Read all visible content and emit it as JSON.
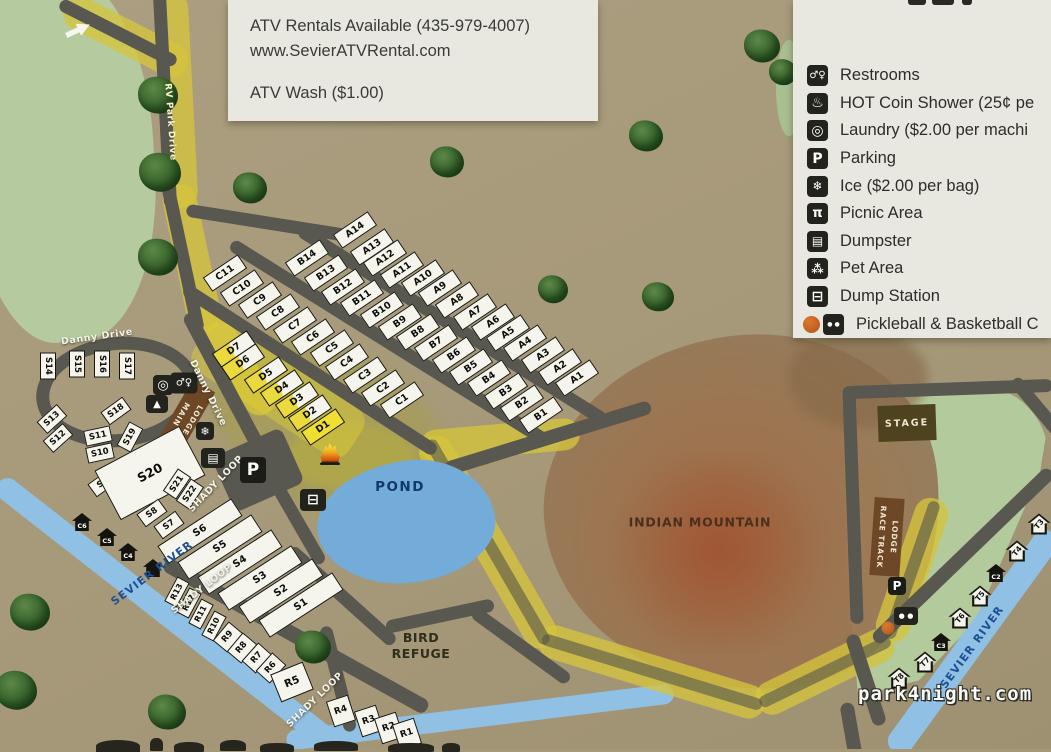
{
  "info_panel": {
    "line1": "ATV Rentals Available (435-979-4007)",
    "line2": "www.SevierATVRental.com",
    "line3": "ATV Wash ($1.00)"
  },
  "legend": {
    "items": [
      {
        "name": "restrooms",
        "glyph": "♂♀",
        "gsize": 10,
        "label": "Restrooms"
      },
      {
        "name": "hot-coin-shower",
        "glyph": "♨",
        "gsize": 14,
        "label": "HOT Coin Shower (25¢ pe"
      },
      {
        "name": "laundry",
        "glyph": "◎",
        "gsize": 14,
        "label": "Laundry ($2.00 per machi"
      },
      {
        "name": "parking",
        "glyph": "P",
        "gsize": 14,
        "label": "Parking"
      },
      {
        "name": "ice",
        "glyph": "❄",
        "gsize": 12,
        "label": "Ice ($2.00 per bag)"
      },
      {
        "name": "picnic-area",
        "glyph": "π",
        "gsize": 13,
        "label": "Picnic Area"
      },
      {
        "name": "dumpster",
        "glyph": "▤",
        "gsize": 12,
        "label": "Dumpster"
      },
      {
        "name": "pet-area",
        "glyph": "⁂",
        "gsize": 12,
        "label": "Pet Area"
      },
      {
        "name": "dump-station",
        "glyph": "⊟",
        "gsize": 14,
        "label": "Dump Station"
      },
      {
        "name": "pickleball-basketball",
        "glyph": "● ●",
        "gsize": 6,
        "label": "Pickleball & Basketball C",
        "ball": true
      }
    ]
  },
  "watermark": "park4night.com",
  "map": {
    "labels": [
      [
        "Danny Drive",
        97,
        337,
        -8,
        "road"
      ],
      [
        "Danny Drive",
        208,
        393,
        64,
        "road"
      ],
      [
        "RV Park Drive",
        170,
        122,
        86,
        "roadlt"
      ],
      [
        "SHADY LOOP",
        216,
        484,
        -46,
        "road"
      ],
      [
        "SHADY LOOP",
        202,
        589,
        -38,
        "road"
      ],
      [
        "SHADY LOOP",
        315,
        700,
        -44,
        "road"
      ],
      [
        "SEVIER RIVER",
        152,
        573,
        -37,
        "river"
      ],
      [
        "SEVIER RIVER",
        972,
        647,
        -54,
        "river"
      ],
      [
        "POND",
        400,
        487,
        0,
        "pond"
      ],
      [
        "BIRD\nREFUGE",
        421,
        646,
        0,
        "area"
      ],
      [
        "INDIAN MOUNTAIN",
        700,
        522,
        0,
        "mtn"
      ]
    ],
    "buildings": [
      {
        "label": "STAGE",
        "x": 907,
        "y": 423,
        "w": 58,
        "h": 36,
        "r": -2,
        "cls": "bld-stage",
        "name": "stage-building"
      },
      {
        "label": "RACE TRACK\nLODGE",
        "x": 887,
        "y": 537,
        "w": 30,
        "h": 78,
        "r": 4,
        "cls": "bld-vert",
        "name": "race-track-lodge-building"
      },
      {
        "label": "MAIN\nLODGE",
        "x": 186,
        "y": 417,
        "w": 26,
        "h": 72,
        "r": 30,
        "cls": "bld-vert",
        "name": "main-lodge-building"
      }
    ],
    "sites": [
      [
        "A14",
        355,
        230,
        -34,
        "ab"
      ],
      [
        "A13",
        372,
        247,
        -34,
        "ab"
      ],
      [
        "A12",
        385,
        258,
        -34,
        "ab"
      ],
      [
        "A11",
        402,
        270,
        -34,
        "ab"
      ],
      [
        "A10",
        423,
        278,
        -34,
        "ab"
      ],
      [
        "A9",
        440,
        288,
        -34,
        "ab"
      ],
      [
        "A8",
        457,
        300,
        -34,
        "ab"
      ],
      [
        "A7",
        475,
        312,
        -34,
        "ab"
      ],
      [
        "A6",
        493,
        322,
        -34,
        "ab"
      ],
      [
        "A5",
        508,
        333,
        -34,
        "ab"
      ],
      [
        "A4",
        525,
        343,
        -34,
        "ab"
      ],
      [
        "A3",
        543,
        355,
        -34,
        "ab"
      ],
      [
        "A2",
        560,
        367,
        -34,
        "ab"
      ],
      [
        "A1",
        577,
        378,
        -34,
        "ab"
      ],
      [
        "B14",
        307,
        258,
        -34,
        "ab"
      ],
      [
        "B13",
        326,
        273,
        -34,
        "ab"
      ],
      [
        "B12",
        343,
        287,
        -34,
        "ab"
      ],
      [
        "B11",
        362,
        298,
        -34,
        "ab"
      ],
      [
        "B10",
        382,
        310,
        -34,
        "ab"
      ],
      [
        "B9",
        400,
        322,
        -34,
        "ab"
      ],
      [
        "B8",
        418,
        332,
        -34,
        "ab"
      ],
      [
        "B7",
        436,
        343,
        -34,
        "ab"
      ],
      [
        "B6",
        454,
        355,
        -34,
        "ab"
      ],
      [
        "B5",
        471,
        367,
        -34,
        "ab"
      ],
      [
        "B4",
        489,
        378,
        -34,
        "ab"
      ],
      [
        "B3",
        506,
        391,
        -34,
        "ab"
      ],
      [
        "B2",
        522,
        403,
        -34,
        "ab"
      ],
      [
        "B1",
        541,
        415,
        -34,
        "ab"
      ],
      [
        "C11",
        225,
        273,
        -34,
        "ab"
      ],
      [
        "C10",
        242,
        288,
        -34,
        "ab"
      ],
      [
        "C9",
        260,
        300,
        -34,
        "ab"
      ],
      [
        "C8",
        278,
        312,
        -34,
        "ab"
      ],
      [
        "C7",
        295,
        325,
        -34,
        "ab"
      ],
      [
        "C6",
        313,
        337,
        -34,
        "ab"
      ],
      [
        "C5",
        332,
        348,
        -34,
        "ab"
      ],
      [
        "C4",
        347,
        362,
        -34,
        "ab"
      ],
      [
        "C3",
        365,
        375,
        -34,
        "ab"
      ],
      [
        "C2",
        383,
        388,
        -34,
        "ab"
      ],
      [
        "C1",
        402,
        400,
        -34,
        "ab"
      ],
      [
        "D7",
        234,
        349,
        -34,
        "d"
      ],
      [
        "D6",
        243,
        362,
        -34,
        "d"
      ],
      [
        "D5",
        266,
        375,
        -34,
        "d"
      ],
      [
        "D4",
        282,
        388,
        -34,
        "d"
      ],
      [
        "D3",
        297,
        400,
        -34,
        "d"
      ],
      [
        "D2",
        310,
        413,
        -34,
        "d"
      ],
      [
        "D1",
        323,
        427,
        -34,
        "d1"
      ],
      [
        "S14",
        48,
        366,
        90,
        "sv"
      ],
      [
        "S15",
        77,
        364,
        90,
        "sv"
      ],
      [
        "S16",
        102,
        364,
        90,
        "sv"
      ],
      [
        "S17",
        127,
        366,
        90,
        "sv"
      ],
      [
        "S13",
        52,
        419,
        -42,
        "sv"
      ],
      [
        "S12",
        58,
        438,
        -42,
        "sv"
      ],
      [
        "S18",
        116,
        411,
        -36,
        "sv"
      ],
      [
        "S11",
        98,
        436,
        -12,
        "sv"
      ],
      [
        "S10",
        100,
        453,
        -12,
        "sv"
      ],
      [
        "S19",
        130,
        437,
        -62,
        "sv"
      ],
      [
        "S9",
        103,
        483,
        -36,
        "sv"
      ],
      [
        "S20",
        150,
        473,
        -28,
        "s20"
      ],
      [
        "S21",
        177,
        484,
        -56,
        "sv"
      ],
      [
        "S22",
        190,
        494,
        -56,
        "sv"
      ],
      [
        "S8",
        152,
        513,
        -36,
        "sv"
      ],
      [
        "S7",
        169,
        525,
        -36,
        "sv"
      ],
      [
        "S6",
        200,
        531,
        -33,
        "lg"
      ],
      [
        "S5",
        220,
        547,
        -33,
        "lg"
      ],
      [
        "S4",
        240,
        562,
        -33,
        "lg"
      ],
      [
        "S3",
        260,
        578,
        -33,
        "lg"
      ],
      [
        "S2",
        281,
        591,
        -33,
        "lg"
      ],
      [
        "S1",
        301,
        605,
        -33,
        "lg"
      ],
      [
        "R13",
        177,
        592,
        -62,
        "rv"
      ],
      [
        "R12",
        189,
        603,
        -62,
        "rv"
      ],
      [
        "R11",
        201,
        614,
        -62,
        "rv"
      ],
      [
        "R10",
        214,
        626,
        -62,
        "rv"
      ],
      [
        "R9",
        228,
        637,
        -50,
        "rs"
      ],
      [
        "R8",
        242,
        648,
        -50,
        "rs"
      ],
      [
        "R7",
        257,
        658,
        -48,
        "rs"
      ],
      [
        "R6",
        271,
        668,
        -48,
        "rs"
      ],
      [
        "R5",
        292,
        682,
        -22,
        "r5"
      ],
      [
        "R4",
        341,
        711,
        -18,
        "rb"
      ],
      [
        "R3",
        369,
        721,
        -18,
        "rb"
      ],
      [
        "R2",
        389,
        728,
        -18,
        "rb"
      ],
      [
        "R1",
        407,
        734,
        -18,
        "rb"
      ]
    ],
    "cabins": [
      [
        "C6",
        82,
        522
      ],
      [
        "C5",
        107,
        537
      ],
      [
        "C4",
        128,
        552
      ],
      [
        "C2",
        996,
        573
      ],
      [
        "C3",
        941,
        642
      ]
    ],
    "tent_sites": [
      [
        "T3",
        1039,
        524,
        -50
      ],
      [
        "T4",
        1017,
        551,
        -50
      ],
      [
        "T5",
        980,
        596,
        -50
      ],
      [
        "T6",
        960,
        618,
        -50
      ],
      [
        "T7",
        925,
        662,
        -45
      ],
      [
        "T8",
        899,
        678,
        -45
      ]
    ],
    "icons": [
      {
        "n": "laundry-icon",
        "t": "box",
        "g": "◎",
        "x": 163,
        "y": 385,
        "w": 20,
        "h": 20,
        "f": 13
      },
      {
        "n": "restrooms-icon",
        "t": "box",
        "g": "♂♀",
        "x": 184,
        "y": 383,
        "w": 27,
        "h": 21,
        "f": 10
      },
      {
        "n": "picnic-shelter-icon",
        "t": "box",
        "g": "▲",
        "x": 157,
        "y": 404,
        "w": 22,
        "h": 18,
        "f": 10
      },
      {
        "n": "ice-icon",
        "t": "box",
        "g": "❄",
        "x": 205,
        "y": 431,
        "w": 18,
        "h": 18,
        "f": 11
      },
      {
        "n": "dumpster-icon",
        "t": "box",
        "g": "▤",
        "x": 213,
        "y": 458,
        "w": 24,
        "h": 20,
        "f": 12
      },
      {
        "n": "dump-station-icon",
        "t": "box",
        "g": "⊟",
        "x": 313,
        "y": 500,
        "w": 26,
        "h": 22,
        "f": 14
      },
      {
        "n": "parking-icon-main",
        "t": "pbox",
        "g": "P",
        "x": 253,
        "y": 470,
        "w": 26,
        "h": 26,
        "f": 17
      },
      {
        "n": "parking-icon-racetrack",
        "t": "pbox",
        "g": "P",
        "x": 897,
        "y": 586,
        "w": 18,
        "h": 18,
        "f": 12
      },
      {
        "n": "campfire-icon",
        "t": "flame",
        "x": 330,
        "y": 454
      },
      {
        "n": "pickleball-icon",
        "t": "box",
        "g": "● ●",
        "x": 906,
        "y": 616,
        "w": 24,
        "h": 18,
        "f": 7
      },
      {
        "n": "basketball-icon",
        "t": "ball",
        "x": 888,
        "y": 628,
        "w": 13,
        "h": 13
      },
      {
        "n": "entrance-arrow-icon",
        "t": "arrow",
        "x": 78,
        "y": 30,
        "r": -25
      },
      {
        "n": "shelter-icon",
        "t": "bhouse",
        "x": 153,
        "y": 568
      }
    ],
    "roads": [
      [
        165,
        100,
        215,
        87,
        13
      ],
      [
        118,
        33,
        130,
        27,
        13
      ],
      [
        183,
        258,
        150,
        78,
        13
      ],
      [
        224,
        382,
        155,
        62,
        14
      ],
      [
        268,
        223,
        165,
        9,
        13
      ],
      [
        310,
        370,
        300,
        33,
        13
      ],
      [
        388,
        342,
        370,
        32,
        13
      ],
      [
        452,
        325,
        360,
        32,
        13
      ],
      [
        548,
        438,
        215,
        -17,
        14
      ],
      [
        288,
        505,
        135,
        60,
        13
      ],
      [
        342,
        596,
        140,
        42,
        13
      ],
      [
        440,
        616,
        110,
        -12,
        13
      ],
      [
        521,
        646,
        118,
        36,
        13
      ],
      [
        338,
        679,
        108,
        76,
        13
      ],
      [
        296,
        636,
        300,
        29,
        15
      ],
      [
        853,
        505,
        238,
        88,
        13
      ],
      [
        950,
        389,
        205,
        -2,
        13
      ],
      [
        963,
        556,
        245,
        -44,
        14
      ],
      [
        1038,
        408,
        75,
        50,
        13
      ],
      [
        866,
        680,
        95,
        72,
        14
      ],
      [
        851,
        730,
        55,
        80,
        14
      ]
    ],
    "highlight_bands": [
      [
        176,
        100,
        215,
        87,
        34,
        "ysg"
      ],
      [
        126,
        37,
        135,
        27,
        34,
        "ysg"
      ],
      [
        192,
        258,
        150,
        78,
        34,
        "ysg"
      ],
      [
        235,
        360,
        125,
        58,
        32,
        "ysg"
      ],
      [
        488,
        542,
        240,
        60,
        34,
        "ysg"
      ],
      [
        652,
        672,
        235,
        17,
        34,
        "ysg"
      ],
      [
        825,
        672,
        150,
        -26,
        34,
        "ysg"
      ],
      [
        912,
        570,
        150,
        -71,
        34,
        "ysg"
      ],
      [
        500,
        440,
        160,
        -5,
        32,
        "ysg"
      ],
      [
        278,
        390,
        185,
        33,
        56,
        "ysg2"
      ]
    ],
    "road_cores": [
      [
        488,
        542,
        235,
        60,
        12
      ],
      [
        652,
        672,
        230,
        17,
        12
      ],
      [
        825,
        672,
        145,
        -26,
        12
      ],
      [
        912,
        570,
        145,
        -71,
        12
      ]
    ],
    "rivers": [
      [
        168,
        615,
        430,
        38,
        23
      ],
      [
        480,
        717,
        390,
        -7,
        20
      ],
      [
        973,
        642,
        270,
        -54,
        26
      ]
    ],
    "trees": [
      [
        158,
        95,
        40
      ],
      [
        160,
        172,
        42
      ],
      [
        158,
        257,
        40
      ],
      [
        250,
        188,
        34
      ],
      [
        447,
        162,
        34
      ],
      [
        646,
        136,
        34
      ],
      [
        762,
        46,
        36
      ],
      [
        658,
        297,
        32
      ],
      [
        553,
        289,
        30
      ],
      [
        783,
        72,
        28
      ],
      [
        30,
        612,
        40
      ],
      [
        16,
        690,
        42
      ],
      [
        167,
        712,
        38
      ],
      [
        313,
        647,
        36
      ]
    ]
  }
}
